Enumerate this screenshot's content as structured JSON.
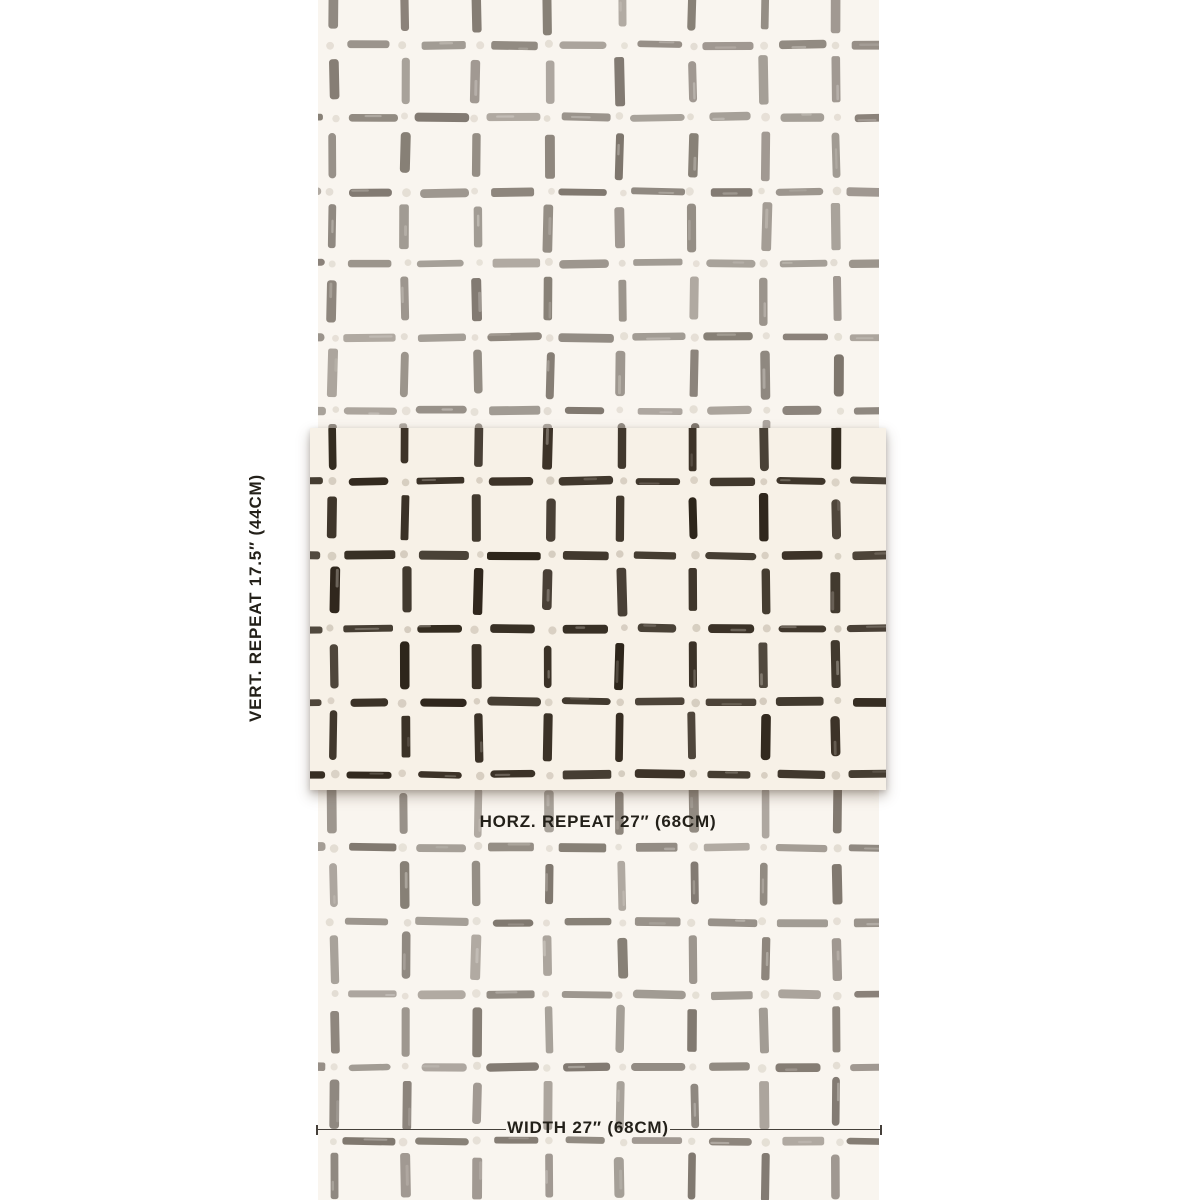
{
  "page": {
    "background": "#ffffff",
    "width": 1200,
    "height": 1200,
    "description": "Wallpaper repeat measurement diagram"
  },
  "labels": {
    "vertical_repeat": "VERT. REPEAT 17.5″ (44CM)",
    "horizontal_repeat": "HORZ. REPEAT 27″ (68CM)",
    "width": "WIDTH 27″ (68CM)"
  },
  "text_color": "#232019",
  "measurement": {
    "line_color": "#45403a"
  },
  "swatch": {
    "strip": {
      "background": "#f9f5ef",
      "dash_color": "#7e766d",
      "dot_color": "#e3ddd3",
      "dash_opacity_min": 0.58
    },
    "repeat_block": {
      "background": "#f7f1e7",
      "dash_color": "#2c2318",
      "dot_color": "#d5ccbf",
      "dash_opacity_min": 0.82
    }
  },
  "pattern": {
    "type": "hand-painted grid of dashes with dots at intersections",
    "strip": {
      "left": 318,
      "top": 0,
      "width": 561,
      "height": 1200,
      "cols": [
        15,
        87,
        159,
        231,
        303,
        375,
        447,
        519
      ],
      "col_spacing": 72,
      "row_start": 45,
      "row_spacing": 73,
      "row_end": 1143,
      "seed": 11
    },
    "repeat_block": {
      "left": 310,
      "top": 428,
      "width": 576,
      "height": 362,
      "cols": [
        23,
        95,
        167,
        239,
        311,
        383,
        455,
        527
      ],
      "col_spacing": 72,
      "row_start": 54,
      "row_spacing": 73,
      "row_end": 350,
      "seed": 29
    }
  }
}
